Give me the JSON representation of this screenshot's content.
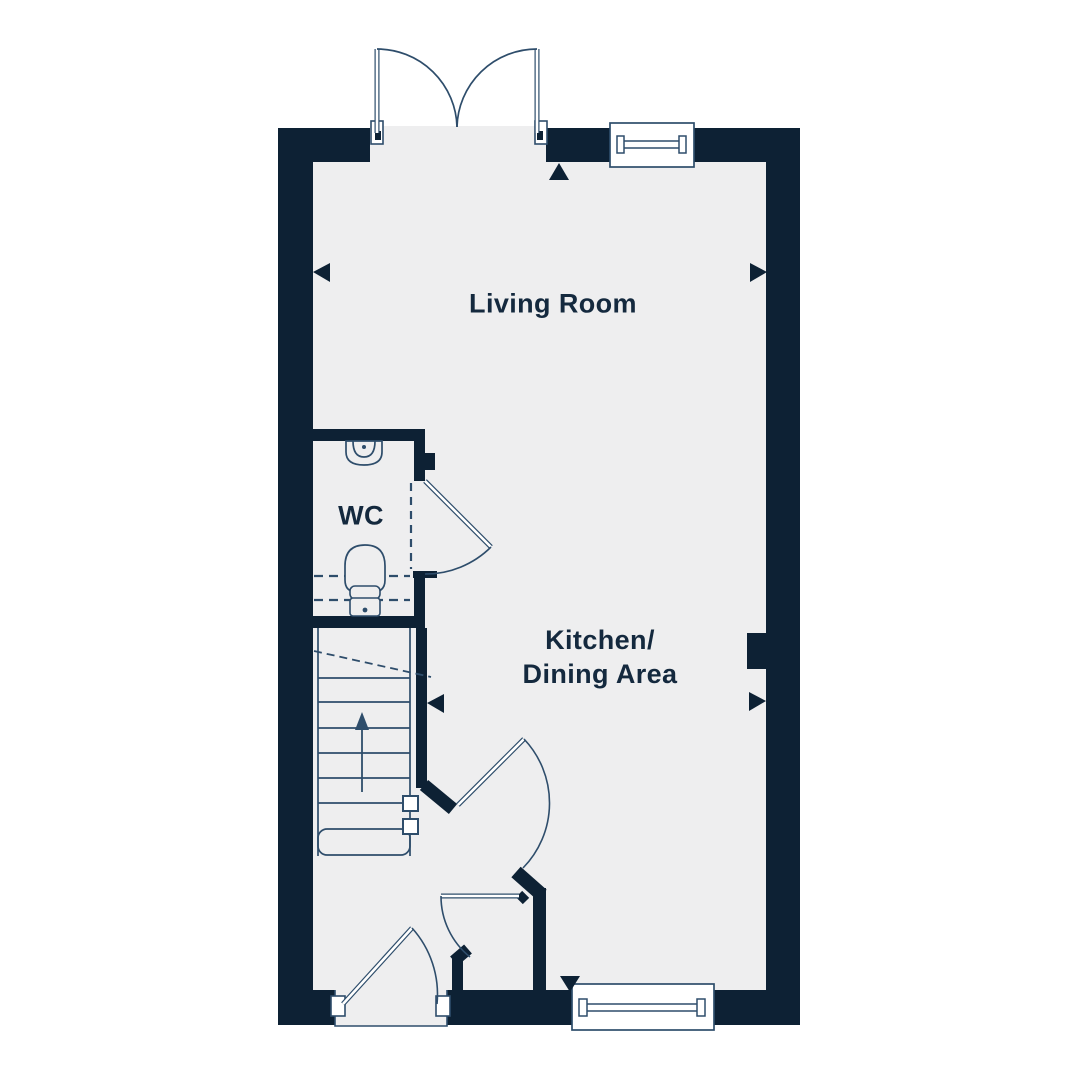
{
  "rooms": {
    "living_room": {
      "label": "Living Room"
    },
    "wc": {
      "label": "WC"
    },
    "kitchen_dining": {
      "label_line1": "Kitchen/",
      "label_line2": "Dining Area"
    }
  },
  "colors": {
    "wall": "#0d2134",
    "floor": "#eeeeef",
    "line": "#2e4d6b",
    "background": "#ffffff",
    "text": "#14293e"
  }
}
